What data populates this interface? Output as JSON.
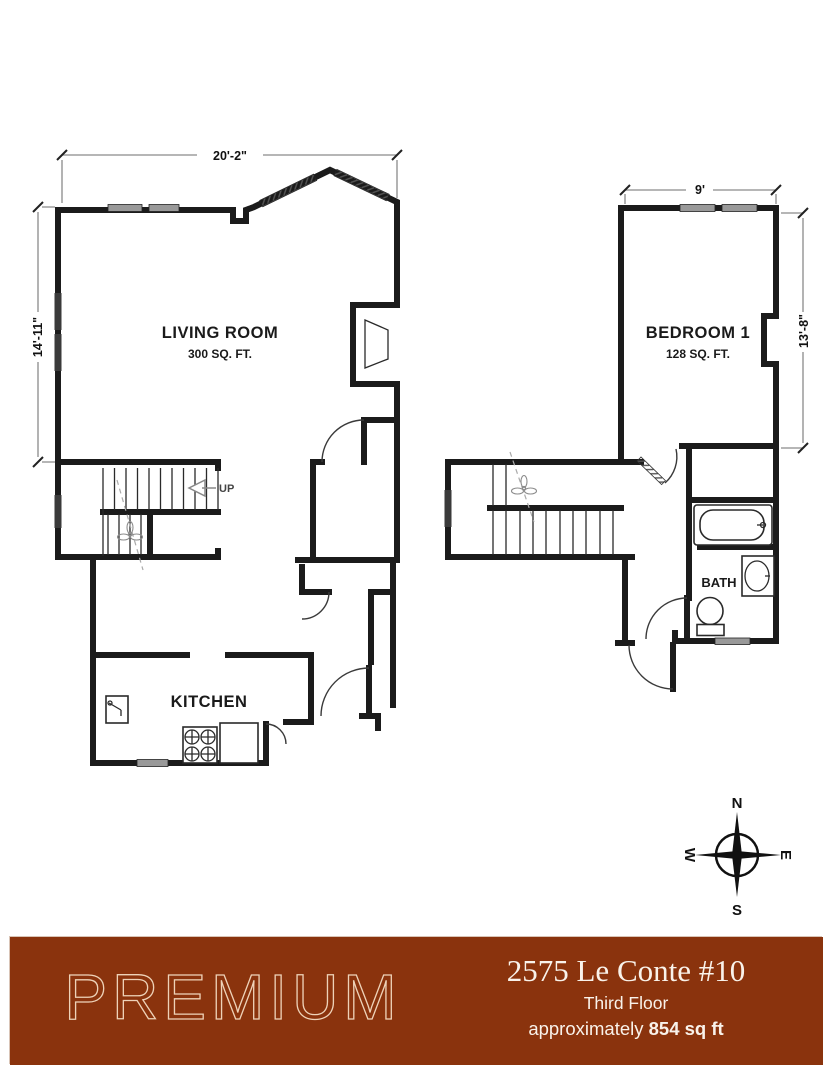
{
  "plans": {
    "left_unit": {
      "living_room_label": "LIVING ROOM",
      "living_room_area": "300 SQ. FT.",
      "kitchen_label": "KITCHEN",
      "stairs_up_label": "UP",
      "dim_width": "20'-2\"",
      "dim_height": "14'-11\""
    },
    "right_unit": {
      "bedroom_label": "BEDROOM 1",
      "bedroom_area": "128 SQ. FT.",
      "bath_label": "BATH",
      "dim_width": "9'",
      "dim_height": "13'-8\""
    }
  },
  "compass": {
    "north": "N",
    "south": "S",
    "east": "E",
    "west": "W"
  },
  "footer": {
    "brand": "PREMIUM",
    "address": "2575 Le Conte #10",
    "floor": "Third Floor",
    "area_prefix": "approximately ",
    "area_value": "854 sq ft",
    "banner_color": "#8a330d"
  }
}
